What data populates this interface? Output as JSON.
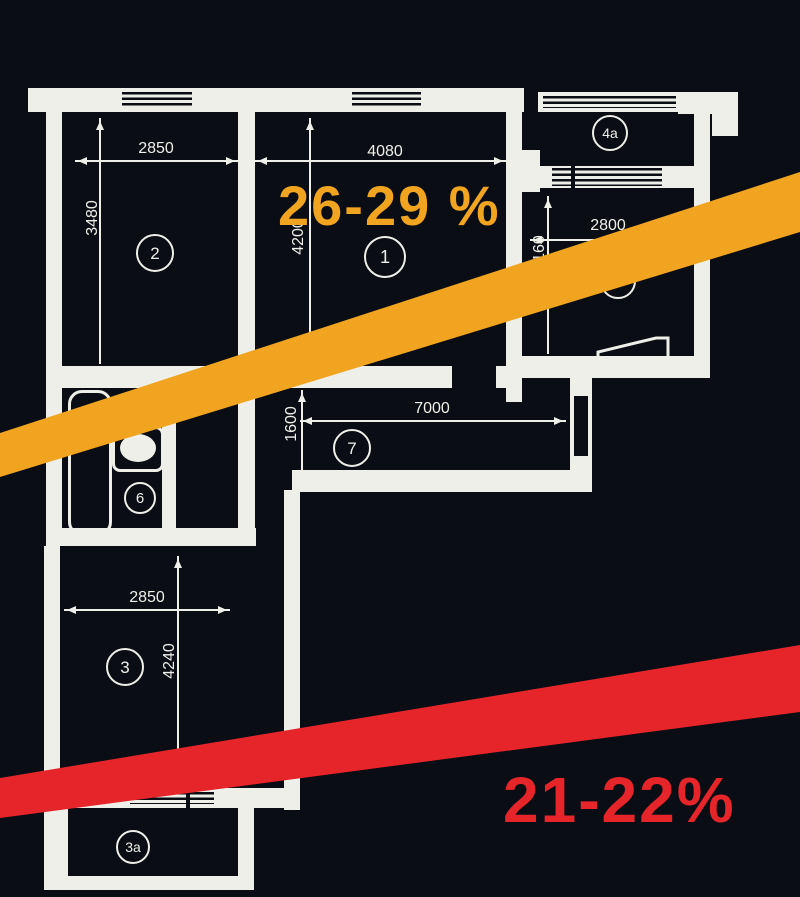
{
  "colors": {
    "background": "#0a0d13",
    "plan_line": "#efefe9",
    "stripe_yellow": "#f1a41f",
    "stripe_red": "#e6252b"
  },
  "plan": {
    "rooms": [
      {
        "number": "1"
      },
      {
        "number": "2"
      },
      {
        "number": "3"
      },
      {
        "number": "3a"
      },
      {
        "number": "4"
      },
      {
        "number": "4a"
      },
      {
        "number": "6"
      },
      {
        "number": "7"
      }
    ],
    "dimensions": [
      {
        "label": "2850"
      },
      {
        "label": "3480"
      },
      {
        "label": "4080"
      },
      {
        "label": "4200"
      },
      {
        "label": "2800"
      },
      {
        "label": "3160"
      },
      {
        "label": "7000"
      },
      {
        "label": "1600"
      },
      {
        "label": "2850"
      },
      {
        "label": "4240"
      }
    ]
  },
  "overlays": {
    "yellow_stripe": {
      "points": "0,433 800,172 800,232 0,477",
      "color": "#f1a41f"
    },
    "red_stripe": {
      "points": "0,778 800,645 800,712 0,818",
      "color": "#e6252b"
    },
    "yellow_label": {
      "text": "26-29 %",
      "color": "#f1a41f"
    },
    "red_label": {
      "text": "21-22%",
      "color": "#e6252b"
    }
  }
}
